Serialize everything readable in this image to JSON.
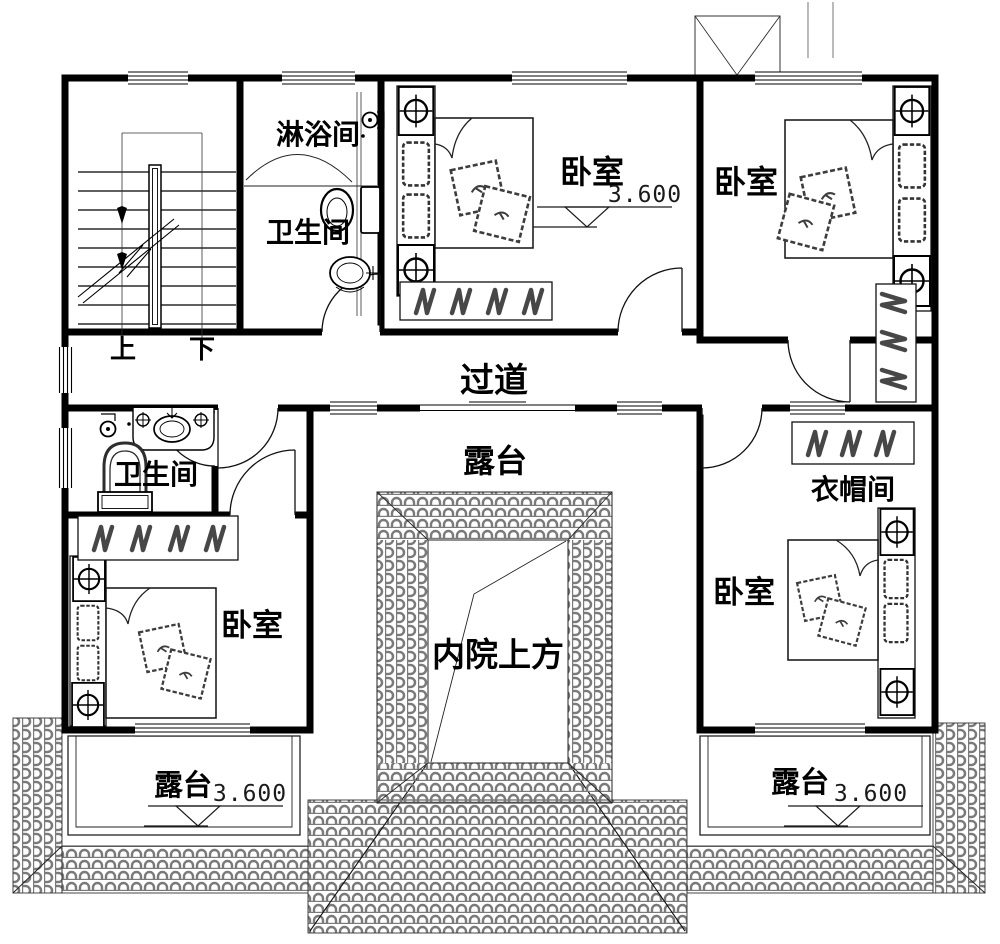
{
  "rooms": {
    "shower_room": {
      "label": "淋浴间"
    },
    "bathroom_upper": {
      "label": "卫生间"
    },
    "bedroom_top_center": {
      "label": "卧室",
      "elevation": "3.600"
    },
    "bedroom_top_right": {
      "label": "卧室"
    },
    "hallway": {
      "label": "过道"
    },
    "terrace_center": {
      "label": "露台"
    },
    "bathroom_lower_left": {
      "label": "卫生间"
    },
    "bedroom_bottom_left": {
      "label": "卧室"
    },
    "cloakroom": {
      "label": "衣帽间"
    },
    "bedroom_bottom_right": {
      "label": "卧室"
    },
    "inner_courtyard": {
      "label": "内院上方"
    },
    "terrace_bottom_left": {
      "label": "露台",
      "elevation": "3.600"
    },
    "terrace_bottom_right": {
      "label": "露台",
      "elevation": "3.600"
    }
  },
  "stairs": {
    "up": "上",
    "down": "下"
  },
  "colors": {
    "wall": "#000000",
    "tile_stroke": "#7a7a7a",
    "hatch": "#474747",
    "background": "#ffffff"
  }
}
